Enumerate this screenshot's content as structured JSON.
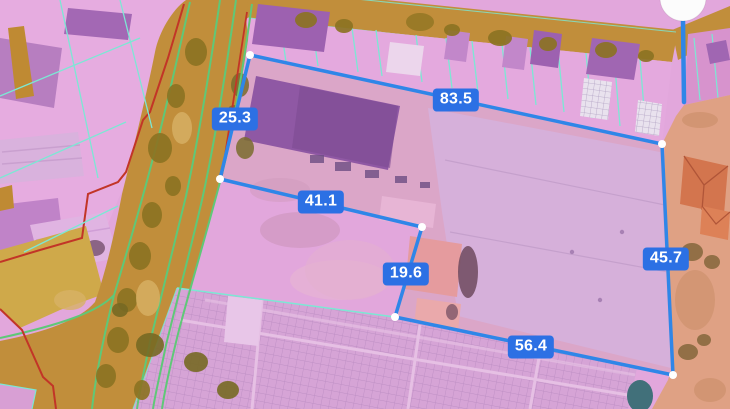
{
  "map_overlay": {
    "measurements": [
      {
        "segment": "west-frontage",
        "value": "25.3"
      },
      {
        "segment": "north-boundary",
        "value": "83.5"
      },
      {
        "segment": "mid-west",
        "value": "41.1"
      },
      {
        "segment": "mid-inset",
        "value": "19.6"
      },
      {
        "segment": "east-boundary",
        "value": "45.7"
      },
      {
        "segment": "south-boundary",
        "value": "56.4"
      }
    ],
    "colors": {
      "measure_line": "#2f86e8",
      "label_background": "#2c70e4",
      "label_text": "#ffffff",
      "parcel_boundary_cyan": "#7ce8d4",
      "road_fill": "#c18e3b",
      "road_line_green": "#5fc878",
      "zone_boundary_red": "#c23527",
      "parcel_overlay_purple": "#e2a7dc",
      "zone_salmon": "#dfa184"
    },
    "icons": [
      {
        "name": "measurement-vertex-dot",
        "shape": "small-white-circle"
      },
      {
        "name": "measurement-handle",
        "shape": "large-white-circle"
      }
    ]
  }
}
